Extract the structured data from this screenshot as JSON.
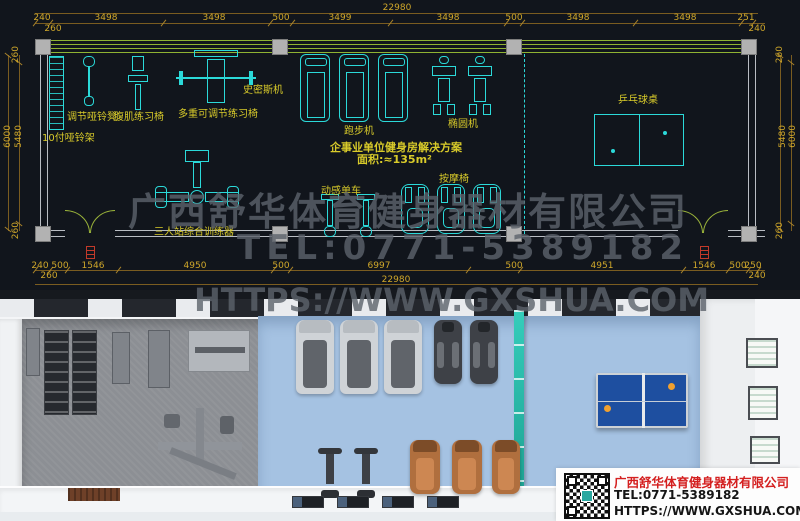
{
  "plan": {
    "dims_top": {
      "total": "22980",
      "segments": [
        "240",
        "3498",
        "3498",
        "500",
        "3499",
        "3498",
        "500",
        "3498",
        "3498",
        "251"
      ],
      "left_inner": "260",
      "right_inner": "240"
    },
    "dims_bottom": {
      "total": "22980",
      "segments": [
        "240",
        "500",
        "1546",
        "4950",
        "500",
        "6997",
        "500",
        "4951",
        "1546",
        "500",
        "250"
      ],
      "left_inner": "260",
      "right_inner": "240"
    },
    "dims_left": {
      "outer": "6000",
      "inner": "5480",
      "top": "260",
      "bottom": "260"
    },
    "dims_right": {
      "outer": "6000",
      "inner": "5480",
      "top": "260",
      "bottom": "260"
    },
    "labels": {
      "dumbbell_rack": "10付哑铃架",
      "dumbbell_bench": "调节哑铃凳",
      "ab_bench": "腹肌练习椅",
      "multi_bench": "多重可调节练习椅",
      "smith_machine": "史密斯机",
      "treadmill": "跑步机",
      "elliptical": "椭圆机",
      "pingpong_table": "乒乓球桌",
      "trainer": "三人站综合训练器",
      "spin_bike": "动感单车",
      "massage_chair": "按摩椅"
    },
    "solution": {
      "title": "企事业单位健身房解决方案",
      "area": "面积:≈135m²"
    }
  },
  "watermark": {
    "line1": "广西舒华体育健身器材有限公司",
    "line2": "TEL:0771-5389182",
    "line3": "HTTPS://WWW.GXSHUA.COM"
  },
  "info_box": {
    "company": "广西舒华体育健身器材有限公司",
    "tel": "TEL:0771-5389182",
    "url": "HTTPS://WWW.GXSHUA.COM"
  },
  "colors": {
    "cad_background": "#11151c",
    "dimension_text": "#cfa72a",
    "wall_green": "#8fb332",
    "equipment_cyan": "#2bd9d9",
    "label_yellow": "#d9cb2a",
    "column_gray": "#b2b2b2",
    "door_symbol_red": "#c23a2a",
    "partition_teal": "#2cc0b0",
    "floor_blue": "#a5c2e2",
    "floor_gray": "#8c8f94",
    "table_blue": "#1e4fa0",
    "massage_chair_brown": "#b06f3e",
    "company_red": "#d42020"
  }
}
